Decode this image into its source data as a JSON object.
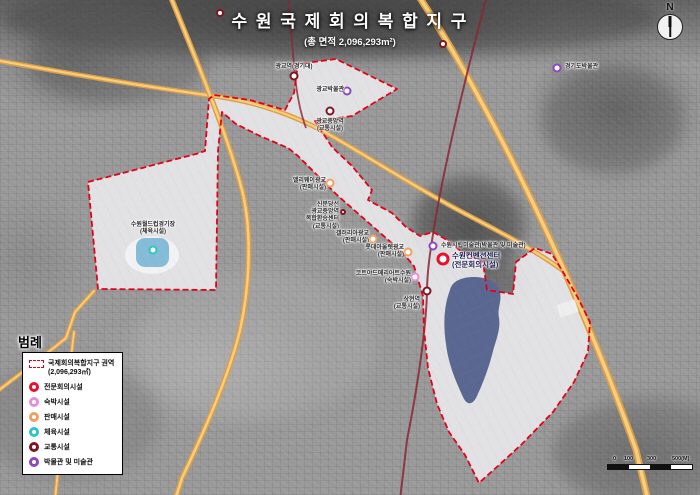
{
  "title": {
    "main": "수 원 국 제 회 의 복 합 지 구",
    "subtitle": "(총 면적 2,096,293m²)"
  },
  "compass": {
    "label": "N"
  },
  "scalebar": {
    "ticks": [
      {
        "label": "0",
        "pos": 6
      },
      {
        "label": "100",
        "pos": 17
      },
      {
        "label": "300",
        "pos": 40
      },
      {
        "label": "500(M)",
        "pos": 65
      }
    ]
  },
  "legend": {
    "title": "범례",
    "area_item": {
      "label": "국제회의복합지구 권역",
      "sublabel": "(2,096,293㎡)"
    },
    "items": [
      {
        "id": "conference",
        "label": "전문회의시설",
        "color": "red"
      },
      {
        "id": "lodging",
        "label": "숙박시설",
        "color": "pink"
      },
      {
        "id": "retail",
        "label": "판매시설",
        "color": "orange"
      },
      {
        "id": "sports",
        "label": "체육시설",
        "color": "cyan"
      },
      {
        "id": "transport",
        "label": "교통시설",
        "color": "maroon"
      },
      {
        "id": "museum",
        "label": "박물관 및 미술관",
        "color": "purple"
      }
    ]
  },
  "colors": {
    "boundary": "#e50019",
    "district_fill": "#e7e7eb",
    "lake": "#5a6791",
    "pond": "#85bcd8",
    "railway": "#8b2634",
    "road_outer": "#dd9f45",
    "road_inner": "#f6ce82",
    "marker": {
      "red": "#e8112d",
      "pink": "#e58fd6",
      "orange": "#f0a060",
      "cyan": "#2cc5c8",
      "maroon": "#7e1622",
      "purple": "#8f45c0"
    }
  },
  "map": {
    "places": [
      {
        "id": "gwanggyo-museum",
        "marker": {
          "x": 347,
          "y": 91,
          "color": "purple",
          "size": 9
        },
        "label": {
          "lines": [
            "광교박물관"
          ],
          "x": 299,
          "y": 87,
          "w": 45,
          "align": "right"
        }
      },
      {
        "id": "gwanggyo-station",
        "marker": {
          "x": 294,
          "y": 76,
          "color": "maroon",
          "size": 9
        },
        "label": {
          "lines": [
            "광교역(경기대)"
          ],
          "x": 258,
          "y": 64,
          "w": 72,
          "align": "center"
        }
      },
      {
        "id": "gwanggyo-jungang-station",
        "marker": {
          "x": 330,
          "y": 111,
          "color": "maroon",
          "size": 9
        },
        "label": {
          "lines": [
            "광교중앙역",
            "(교통시설)"
          ],
          "x": 300,
          "y": 119,
          "w": 60,
          "align": "center"
        }
      },
      {
        "id": "transfer-center",
        "marker": {
          "x": 343,
          "y": 212,
          "color": "maroon",
          "size": 6
        },
        "label": {
          "lines": [
            "신분당선",
            "광교중앙역",
            "복합환승센터",
            "(교통시설)"
          ],
          "x": 293,
          "y": 202,
          "w": 46,
          "align": "right"
        }
      },
      {
        "id": "alleyway-gwanggyo",
        "marker": {
          "x": 330,
          "y": 183,
          "color": "orange",
          "size": 9
        },
        "label": {
          "lines": [
            "앨리웨이광교",
            "(판매시설)"
          ],
          "x": 282,
          "y": 178,
          "w": 44,
          "align": "right"
        }
      },
      {
        "id": "galleria-gwanggyo",
        "marker": {
          "x": 373,
          "y": 239,
          "color": "orange",
          "size": 9
        },
        "label": {
          "lines": [
            "갤러리아광교",
            "(판매시설)"
          ],
          "x": 330,
          "y": 231,
          "w": 39,
          "align": "right"
        }
      },
      {
        "id": "lotte-outlet-gwanggyo",
        "marker": {
          "x": 408,
          "y": 252,
          "color": "orange",
          "size": 9
        },
        "label": {
          "lines": [
            "롯데아울렛광교",
            "(판매시설)"
          ],
          "x": 355,
          "y": 245,
          "w": 49,
          "align": "right"
        }
      },
      {
        "id": "courtyard-marriott",
        "marker": {
          "x": 415,
          "y": 277,
          "color": "pink",
          "size": 9
        },
        "label": {
          "lines": [
            "코트야드메리어트수원",
            "(숙박시설)"
          ],
          "x": 339,
          "y": 271,
          "w": 72,
          "align": "right"
        }
      },
      {
        "id": "suwon-art-museum",
        "marker": {
          "x": 433,
          "y": 246,
          "color": "purple",
          "size": 9
        },
        "label": {
          "lines": [
            "수원시립미술관(박물관 및 미술관)"
          ],
          "x": 441,
          "y": 243,
          "w": 112,
          "align": "left"
        }
      },
      {
        "id": "suwon-convention-center",
        "marker": {
          "x": 443,
          "y": 259,
          "color": "red",
          "size": 13
        },
        "label": {
          "lines": [
            "수원컨벤션센터",
            "(전문회의시설)"
          ],
          "x": 452,
          "y": 251,
          "w": 80,
          "align": "left",
          "big": true
        }
      },
      {
        "id": "sanghyeon-station",
        "marker": {
          "x": 427,
          "y": 291,
          "color": "maroon",
          "size": 9
        },
        "label": {
          "lines": [
            "상현역",
            "(교통시설)"
          ],
          "x": 368,
          "y": 297,
          "w": 52,
          "align": "right"
        }
      },
      {
        "id": "worldcup-stadium",
        "marker": {
          "x": 153,
          "y": 250,
          "color": "cyan",
          "size": 9
        },
        "label": {
          "lines": [
            "수원월드컵경기장",
            "(체육시설)"
          ],
          "x": 108,
          "y": 222,
          "w": 90,
          "align": "center"
        }
      },
      {
        "id": "gyeonggi-museum",
        "marker": {
          "x": 557,
          "y": 68,
          "color": "purple",
          "size": 9
        },
        "label": {
          "lines": [
            "경기도박물관"
          ],
          "x": 565,
          "y": 64,
          "w": 60,
          "align": "left"
        }
      },
      {
        "id": "station-ring-1",
        "marker": {
          "x": 220,
          "y": 13,
          "color": "maroon",
          "size": 8
        },
        "label": {
          "lines": [],
          "x": 0,
          "y": 0,
          "w": 0,
          "align": "left"
        }
      },
      {
        "id": "station-ring-2",
        "marker": {
          "x": 443,
          "y": 44,
          "color": "maroon",
          "size": 8
        },
        "label": {
          "lines": [],
          "x": 0,
          "y": 0,
          "w": 0,
          "align": "left"
        }
      }
    ]
  }
}
